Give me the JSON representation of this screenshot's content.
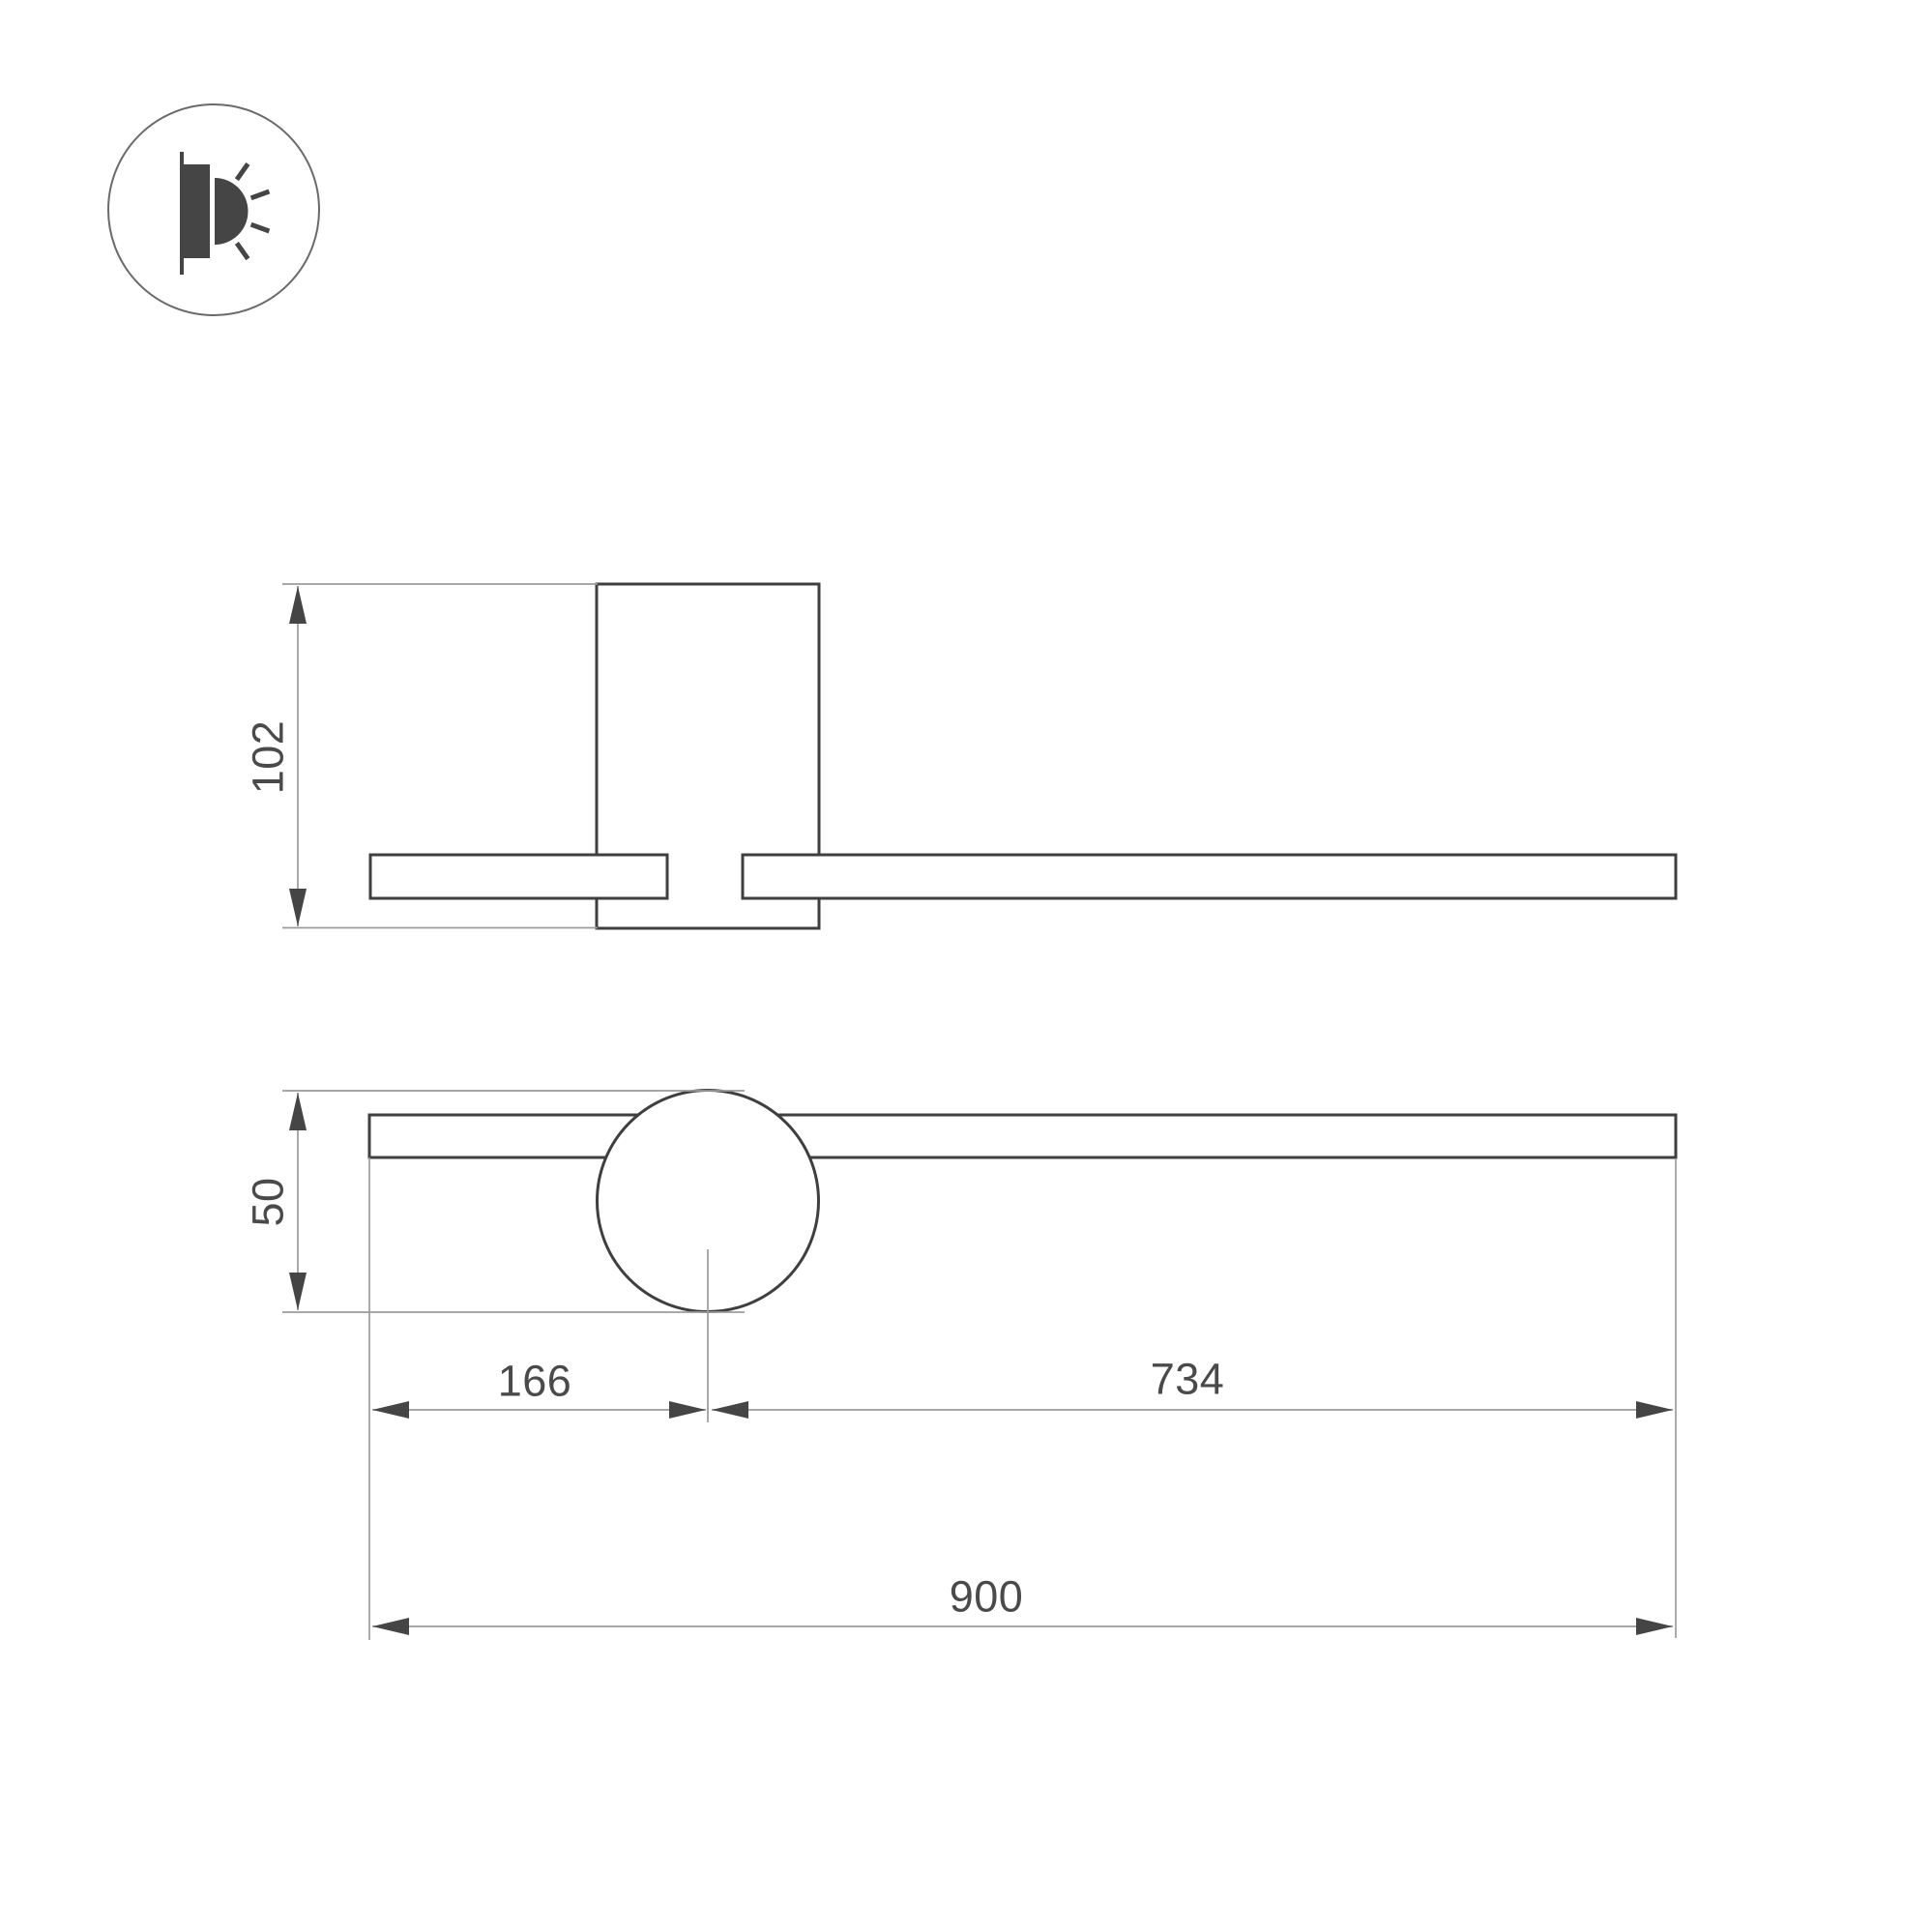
{
  "icon": {
    "name": "wall-light-icon"
  },
  "dimensions": {
    "side_height": "102",
    "base_diameter": "50",
    "left_offset": "166",
    "right_offset": "734",
    "total_length": "900"
  },
  "colors": {
    "outline": "#3f3f3f",
    "thin_line": "#9b9b9b",
    "arrow": "#454545",
    "text": "#4a4a4a",
    "background": "#ffffff",
    "fill": "#ffffff"
  }
}
